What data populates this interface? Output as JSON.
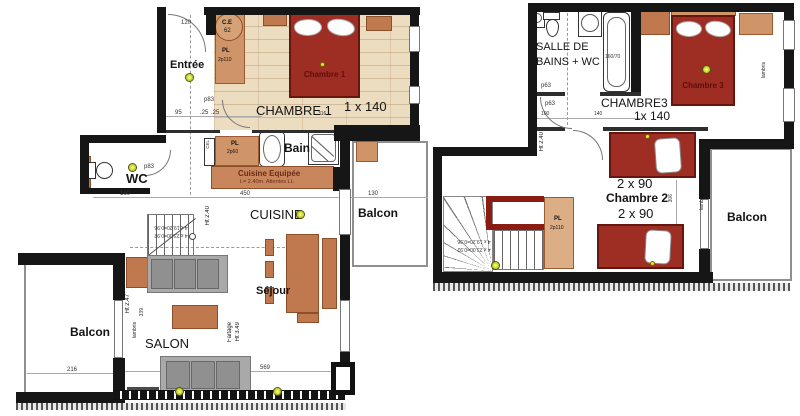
{
  "plans": {
    "ground": {
      "labels": {
        "entree": "Entrée",
        "chambre1_room": "CHAMBRE 1",
        "chambre1_size": "1 x 140",
        "chambre1_bed": "Chambre 1",
        "wc": "WC",
        "bain": "Bain",
        "cel": "CEL",
        "ce_1": "C.E",
        "ce_2": "62",
        "pl_top_1": "PL",
        "pl_top_2": "2p110",
        "pl_mid_1": "PL",
        "pl_mid_2": "2p60",
        "cuisine_equipee": "Cuisine Equipée",
        "cuisine_equipee_sub": "L= 2.40m.   Attentes LL",
        "cuisine": "CUISINE",
        "balcon_mid": "Balcon",
        "balcon_left": "Balcon",
        "salon": "SALON",
        "sejour": "Séjour",
        "ht_240": "Ht 2.40",
        "ht_247": "Ht 2.47",
        "faitage": "Faitage",
        "ht_349": "Ht 3.49",
        "lambris": "lambris",
        "stair_1": "4 x 19.20=0.96",
        "stair_2": "4 x 23.00=0.92"
      },
      "dims": {
        "d120": "120",
        "d95": "95",
        "d25a": ".25",
        "d25b": ".25",
        "d316": "316",
        "d160": "160",
        "d450": "450",
        "d130": "130",
        "d216": "216",
        "d339": "339",
        "d569": "569",
        "p83_a": "p83",
        "p83_b": "p83"
      }
    },
    "upper": {
      "labels": {
        "sdb_1": "SALLE DE",
        "sdb_2": "BAINS + WC",
        "bath_size": "160/70",
        "chambre3_room": "CHAMBRE3",
        "chambre3_size": "1x 140",
        "chambre3_bed": "Chambre 3",
        "chambre2": "Chambre 2",
        "twin_top": "2 x 90",
        "twin_bottom": "2 x 90",
        "pl_1": "PL",
        "pl_2": "2p110",
        "balcon": "Balcon",
        "lambris_a": "lambris",
        "lambris_b": "lambris",
        "ht_240": "Ht 2.40",
        "stair_1": "4 x 19.20=0.96",
        "stair_2": "4 x 23.00=0.92"
      },
      "dims": {
        "d100": "100",
        "d140": "140",
        "d306": "306",
        "p63_a": "p63",
        "p63_b": "p63"
      }
    }
  },
  "colors": {
    "wall": "#161616",
    "bed": "#9e2d24",
    "wood_floor": "#ecdcc0",
    "furniture": "#c0784e",
    "closet": "#cf9468",
    "sofa": "#a9a9a9",
    "stair_guardrail": "#8a1d12",
    "ceiling_light": "#c6d426"
  }
}
